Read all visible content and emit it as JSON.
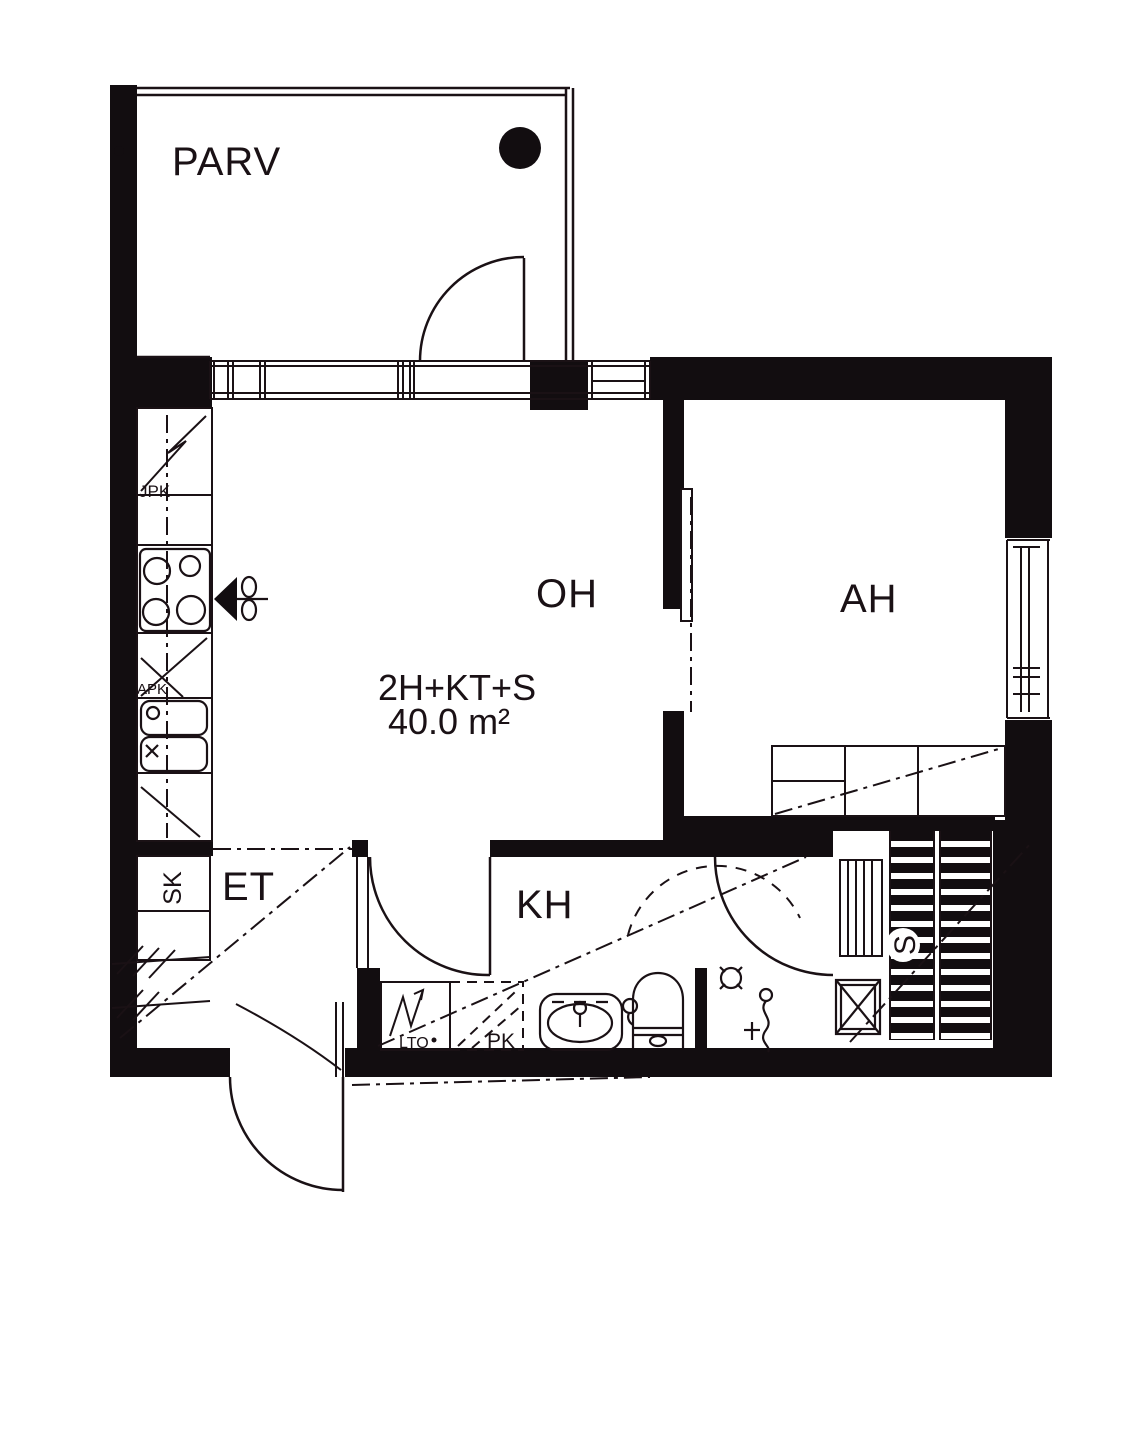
{
  "plan": {
    "apartment": {
      "type_label": "2H+KT+S",
      "area_label": "40.0 m²",
      "area_value": 40.0
    },
    "rooms": [
      {
        "id": "parv",
        "label": "PARV",
        "name": "balcony"
      },
      {
        "id": "oh",
        "label": "OH",
        "name": "living room"
      },
      {
        "id": "ah",
        "label": "AH",
        "name": "sleeping alcove"
      },
      {
        "id": "et",
        "label": "ET",
        "name": "entrance hall"
      },
      {
        "id": "kh",
        "label": "KH",
        "name": "bathroom"
      },
      {
        "id": "s",
        "label": "S",
        "name": "sauna"
      }
    ],
    "fixtures": [
      {
        "id": "jpk",
        "label": "JPK",
        "name": "fridge-freezer"
      },
      {
        "id": "apk",
        "label": "APK",
        "name": "dishwasher"
      },
      {
        "id": "sk",
        "label": "SK",
        "name": "cleaning closet"
      },
      {
        "id": "lto",
        "label": "LTO",
        "name": "heat recovery unit"
      },
      {
        "id": "pk",
        "label": "PK",
        "name": "washing machine reservation"
      }
    ],
    "colors": {
      "line": "#1a1115",
      "wall": "#120d10",
      "background": "#ffffff"
    }
  }
}
